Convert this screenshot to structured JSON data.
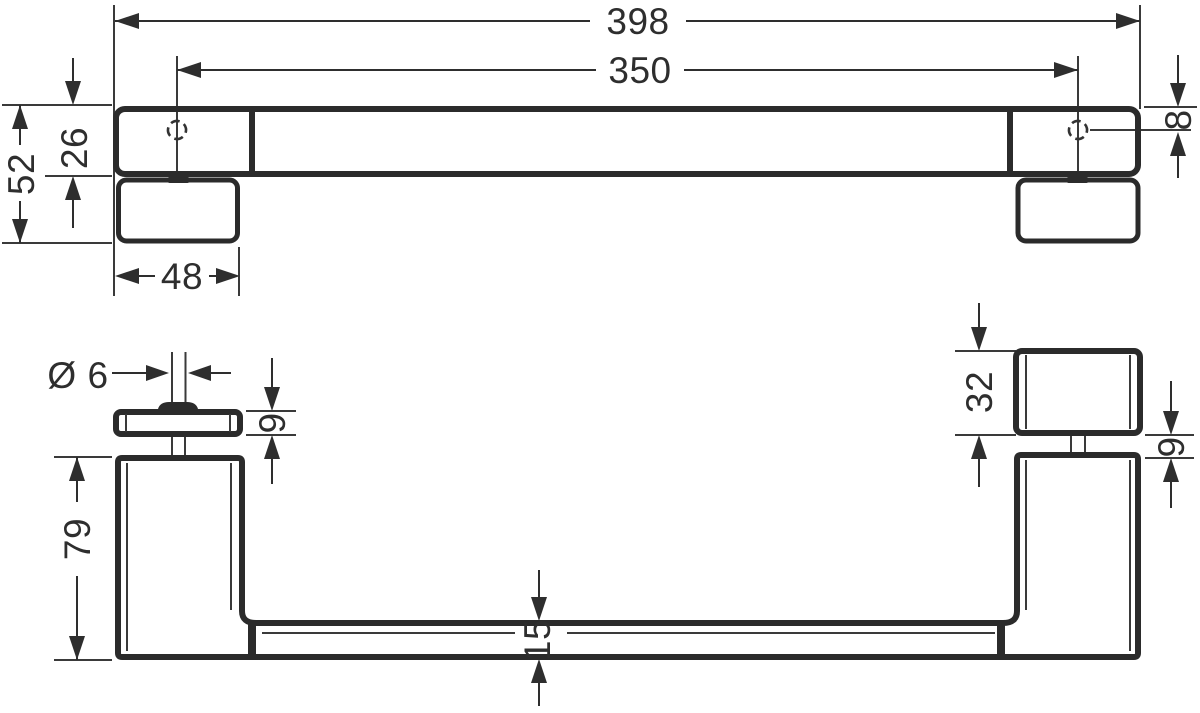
{
  "drawing": {
    "type": "technical-dimension-drawing",
    "background_color": "#ffffff",
    "line_color": "#2b2b2b",
    "views": [
      "top-plan-view",
      "front-elevation-view"
    ],
    "unit": "mm"
  },
  "dimensions": {
    "top_view": {
      "overall_length": "398",
      "hole_spacing": "350",
      "total_depth": "52",
      "bar_depth": "26",
      "plate_width": "48",
      "hole_offset": "8"
    },
    "front_view": {
      "screw_diameter": "Ø 6",
      "left_flange_height": "9",
      "post_height": "79",
      "plate_height": "32",
      "right_flange_gap": "9",
      "bar_thickness": "15"
    }
  }
}
